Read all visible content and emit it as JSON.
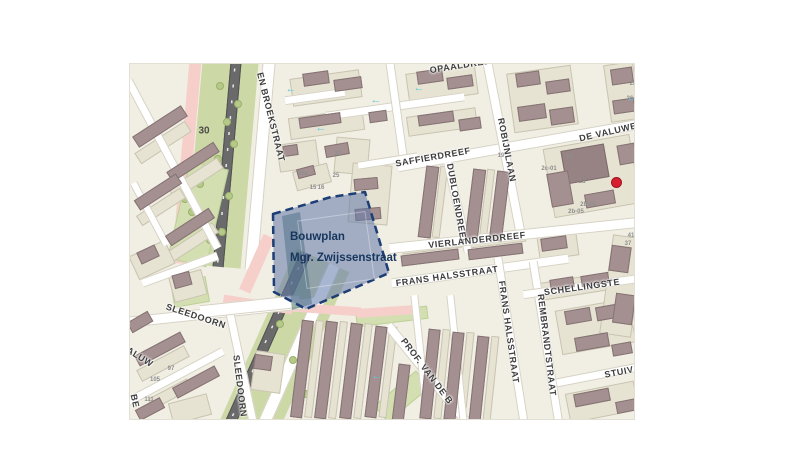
{
  "page": {
    "background": "#ffffff"
  },
  "map": {
    "x": 129,
    "y": 63,
    "w": 506,
    "h": 357,
    "colors": {
      "base": "#f1eee4",
      "street": "#ffffff",
      "parcel": "#e7e3d3",
      "building": "#a49090",
      "building_dark": "#978383",
      "green": "#ccd8a6",
      "tree": "#b5c98a",
      "pink": "#f6cfca",
      "road": "#6a6a6a",
      "label": "#3d3d3d",
      "arrow": "#5fc8de",
      "marker": "#d6202f",
      "plan_fill": "rgba(96,120,170,0.55)",
      "plan_stroke": "#1d3d75",
      "plan_label": "#17365d"
    },
    "bouwplan": {
      "label_line1": "Bouwplan",
      "label_line2": "Mgr. Zwijssenstraat",
      "label_x": 160,
      "label_y": 167,
      "points": "143,150 201,133 235,128 259,209 176,245 144,228",
      "teal_points": "152,152 170,148 182,240 162,246"
    },
    "zone_sign": {
      "text": "30",
      "x": 74,
      "y": 67
    },
    "marker": {
      "x": 486,
      "y": 118,
      "r": 5.5
    },
    "labels": [
      {
        "t": "EN BROEKSTRAAT",
        "x": 141,
        "y": 53,
        "r": 76
      },
      {
        "t": "OPAALDREEF",
        "x": 333,
        "y": 1,
        "r": -9
      },
      {
        "t": "SAFFIERDREEF",
        "x": 303,
        "y": 93,
        "r": -10
      },
      {
        "t": "ROBIJNLAAN",
        "x": 377,
        "y": 86,
        "r": 79
      },
      {
        "t": "DE VALUWE",
        "x": 478,
        "y": 68,
        "r": -13
      },
      {
        "t": "DUBLOENDREEF",
        "x": 327,
        "y": 140,
        "r": 80
      },
      {
        "t": "VIERLANDERDREEF",
        "x": 347,
        "y": 176,
        "r": -6
      },
      {
        "t": "FRANS HALSSTRAAT",
        "x": 317,
        "y": 212,
        "r": -8
      },
      {
        "t": "FRANS HALSSTRAAT",
        "x": 379,
        "y": 268,
        "r": 82
      },
      {
        "t": "REMBRANDTSTRAAT",
        "x": 417,
        "y": 281,
        "r": 83
      },
      {
        "t": "SCHELLINGSTE",
        "x": 452,
        "y": 223,
        "r": -8
      },
      {
        "t": "STUIV",
        "x": 489,
        "y": 308,
        "r": -11
      },
      {
        "t": "SLEEDOORN",
        "x": 66,
        "y": 252,
        "r": 18
      },
      {
        "t": "SLEEDOORN",
        "x": 110,
        "y": 322,
        "r": 83
      },
      {
        "t": "PROF. VAN DE B",
        "x": 297,
        "y": 307,
        "r": 53
      },
      {
        "t": "ALUW",
        "x": 10,
        "y": 293,
        "r": 32
      },
      {
        "t": "BE",
        "x": 5,
        "y": 337,
        "r": 78
      }
    ],
    "house_numbers": [
      {
        "t": "111",
        "x": 19,
        "y": 336
      },
      {
        "t": "105",
        "x": 25,
        "y": 316
      },
      {
        "t": "97",
        "x": 41,
        "y": 305
      },
      {
        "t": "22",
        "x": 208,
        "y": 90
      },
      {
        "t": "26a",
        "x": 173,
        "y": 110
      },
      {
        "t": "15",
        "x": 183,
        "y": 124
      },
      {
        "t": "16",
        "x": 191,
        "y": 124
      },
      {
        "t": "25",
        "x": 206,
        "y": 112
      },
      {
        "t": "19",
        "x": 371,
        "y": 92
      },
      {
        "t": "1b",
        "x": 439,
        "y": 93
      },
      {
        "t": "1a",
        "x": 452,
        "y": 118
      },
      {
        "t": "2c-01",
        "x": 419,
        "y": 105
      },
      {
        "t": "2b-10",
        "x": 458,
        "y": 141
      },
      {
        "t": "2b-05",
        "x": 446,
        "y": 148
      },
      {
        "t": "41",
        "x": 501,
        "y": 172
      },
      {
        "t": "37",
        "x": 498,
        "y": 180
      },
      {
        "t": "28",
        "x": 503,
        "y": 20
      },
      {
        "t": "36",
        "x": 500,
        "y": 35
      }
    ],
    "arrows": [
      [
        161,
        25
      ],
      [
        191,
        64
      ],
      [
        246,
        36
      ],
      [
        289,
        24
      ],
      [
        502,
        34
      ],
      [
        247,
        312
      ]
    ],
    "trees": [
      [
        90,
        22
      ],
      [
        97,
        58
      ],
      [
        88,
        95
      ],
      [
        99,
        132
      ],
      [
        92,
        168
      ],
      [
        70,
        120
      ],
      [
        62,
        148
      ],
      [
        80,
        176
      ],
      [
        55,
        135
      ],
      [
        150,
        260
      ],
      [
        163,
        296
      ],
      [
        176,
        330
      ],
      [
        148,
        238
      ],
      [
        108,
        40
      ],
      [
        104,
        80
      ]
    ],
    "corridor": {
      "segments": [
        {
          "cx": 96,
          "cy": 95,
          "w": 180,
          "h": 215,
          "rot": 5,
          "parts": [
            {
              "name": "cycle-path",
              "kind": "pink",
              "off": -39,
              "w": 12
            },
            {
              "name": "green-corridor",
              "kind": "green",
              "off": -4,
              "w": 56
            },
            {
              "name": "main-road",
              "kind": "road",
              "off": 0,
              "w": 9
            },
            {
              "name": "broekstraat-road",
              "kind": "band",
              "off": 34,
              "w": 13
            }
          ]
        },
        {
          "cx": 136,
          "cy": 275,
          "w": 190,
          "h": 190,
          "rot": 24,
          "parts": [
            {
              "name": "cycle-path",
              "kind": "pink",
              "off": -39,
              "w": 12,
              "hpart": 60
            },
            {
              "name": "green-corridor",
              "kind": "green",
              "off": 20,
              "w": 58
            },
            {
              "name": "main-road",
              "kind": "road",
              "off": 0,
              "w": 9
            },
            {
              "name": "broekstraat-road",
              "kind": "band",
              "off": 32,
              "w": 13
            }
          ]
        }
      ]
    },
    "pink_paths": [
      [
        128,
        240,
        70,
        9,
        9
      ],
      [
        196,
        245,
        70,
        9,
        4
      ],
      [
        256,
        247,
        58,
        9,
        -4
      ]
    ],
    "streets": [
      [
        43,
        100,
        190,
        9,
        62
      ],
      [
        20,
        150,
        70,
        8,
        62
      ],
      [
        50,
        205,
        80,
        9,
        -20
      ],
      [
        90,
        248,
        190,
        11,
        -6
      ],
      [
        111,
        303,
        115,
        9,
        78
      ],
      [
        40,
        315,
        120,
        9,
        -28
      ],
      [
        388,
        81,
        245,
        11,
        -10
      ],
      [
        374,
        84,
        172,
        10,
        79
      ],
      [
        328,
        143,
        92,
        9,
        77
      ],
      [
        384,
        171,
        250,
        11,
        -6
      ],
      [
        350,
        207,
        178,
        10,
        -8
      ],
      [
        381,
        276,
        168,
        9,
        81
      ],
      [
        416,
        278,
        164,
        9,
        81
      ],
      [
        452,
        222,
        118,
        9,
        -8
      ],
      [
        470,
        310,
        88,
        9,
        -11
      ],
      [
        297,
        310,
        125,
        10,
        51
      ],
      [
        291,
        295,
        128,
        8,
        84
      ],
      [
        327,
        295,
        128,
        8,
        84
      ],
      [
        120,
        242,
        100,
        13,
        -6
      ],
      [
        185,
        32,
        60,
        9,
        -8
      ],
      [
        265,
        42,
        140,
        9,
        -8
      ],
      [
        266,
        45,
        95,
        9,
        82
      ],
      [
        258,
        97,
        60,
        8,
        -9
      ]
    ],
    "blocks": [
      [
        "g",
        68,
        150,
        40,
        100,
        13
      ],
      [
        "g",
        60,
        228,
        36,
        26,
        -10
      ],
      [
        "g",
        262,
        252,
        72,
        13,
        -7
      ],
      [
        "g",
        272,
        332,
        22,
        55,
        50
      ],
      [
        "p",
        33,
        78,
        60,
        13,
        -33
      ],
      [
        "p",
        66,
        114,
        58,
        13,
        -33
      ],
      [
        "p",
        31,
        143,
        52,
        12,
        -33
      ],
      [
        "p",
        63,
        178,
        54,
        12,
        -33
      ],
      [
        "p",
        22,
        196,
        40,
        26,
        -25
      ],
      [
        "p",
        58,
        222,
        34,
        26,
        -15
      ],
      [
        "p",
        33,
        299,
        54,
        13,
        -28
      ],
      [
        "p",
        40,
        330,
        44,
        12,
        -28
      ],
      [
        "p",
        60,
        345,
        40,
        22,
        -15
      ],
      [
        "p",
        138,
        308,
        30,
        40,
        8
      ],
      [
        "p",
        184,
        305,
        8,
        98,
        7
      ],
      [
        "p",
        208,
        306,
        8,
        98,
        7
      ],
      [
        "p",
        233,
        307,
        8,
        96,
        7
      ],
      [
        "p",
        258,
        308,
        8,
        92,
        7
      ],
      [
        "p",
        312,
        310,
        8,
        90,
        6
      ],
      [
        "p",
        336,
        312,
        8,
        88,
        6
      ],
      [
        "p",
        361,
        314,
        8,
        85,
        6
      ],
      [
        "p",
        302,
        183,
        60,
        8,
        -7
      ],
      [
        "p",
        367,
        177,
        57,
        8,
        -7
      ],
      [
        "p",
        428,
        182,
        40,
        24,
        -8
      ],
      [
        "p",
        448,
        222,
        80,
        18,
        -9
      ],
      [
        "p",
        465,
        262,
        75,
        45,
        -10
      ],
      [
        "p",
        472,
        338,
        70,
        30,
        -11
      ],
      [
        "p",
        492,
        222,
        32,
        100,
        8
      ],
      [
        "p",
        462,
        112,
        88,
        70,
        -10
      ],
      [
        "p",
        492,
        28,
        30,
        58,
        -8
      ],
      [
        "p",
        412,
        35,
        65,
        60,
        -8
      ],
      [
        "p",
        196,
        24,
        70,
        28,
        -8
      ],
      [
        "p",
        196,
        60,
        75,
        22,
        -8
      ],
      [
        "p",
        168,
        92,
        40,
        28,
        -8
      ],
      [
        "p",
        222,
        92,
        34,
        36,
        5
      ],
      [
        "p",
        182,
        113,
        36,
        20,
        -15
      ],
      [
        "p",
        312,
        20,
        70,
        30,
        -8
      ],
      [
        "p",
        312,
        58,
        70,
        20,
        -8
      ],
      [
        "p",
        357,
        140,
        8,
        70,
        7
      ],
      [
        "p",
        310,
        138,
        8,
        72,
        7
      ],
      [
        "p",
        240,
        130,
        40,
        60,
        5
      ],
      [
        "b",
        30,
        62,
        58,
        13,
        -33
      ],
      [
        "b",
        63,
        98,
        56,
        12,
        -33
      ],
      [
        "b",
        28,
        128,
        50,
        12,
        -33
      ],
      [
        "b",
        60,
        163,
        52,
        12,
        -33
      ],
      [
        "b",
        18,
        190,
        20,
        13,
        -25
      ],
      [
        "b",
        52,
        216,
        18,
        14,
        -15
      ],
      [
        "b",
        30,
        285,
        52,
        12,
        -28
      ],
      [
        "b",
        66,
        318,
        48,
        12,
        -28
      ],
      [
        "b",
        20,
        345,
        28,
        12,
        -28
      ],
      [
        "b",
        10,
        258,
        24,
        12,
        -30
      ],
      [
        "b",
        133,
        298,
        18,
        15,
        8
      ],
      [
        "b",
        172,
        305,
        12,
        98,
        7
      ],
      [
        "b",
        196,
        306,
        12,
        98,
        7
      ],
      [
        "b",
        221,
        307,
        12,
        96,
        7
      ],
      [
        "b",
        246,
        308,
        12,
        92,
        7
      ],
      [
        "b",
        271,
        330,
        12,
        60,
        7
      ],
      [
        "b",
        300,
        310,
        12,
        90,
        6
      ],
      [
        "b",
        324,
        312,
        12,
        88,
        6
      ],
      [
        "b",
        349,
        314,
        12,
        85,
        6
      ],
      [
        "b",
        300,
        193,
        58,
        11,
        -7
      ],
      [
        "b",
        365,
        187,
        55,
        11,
        -7
      ],
      [
        "b",
        424,
        179,
        26,
        13,
        -8
      ],
      [
        "b",
        432,
        219,
        24,
        11,
        -9
      ],
      [
        "b",
        465,
        215,
        28,
        11,
        -9
      ],
      [
        "b",
        448,
        252,
        26,
        14,
        -10
      ],
      [
        "b",
        480,
        248,
        28,
        14,
        -10
      ],
      [
        "b",
        462,
        278,
        34,
        14,
        -10
      ],
      [
        "b",
        492,
        285,
        20,
        12,
        -10
      ],
      [
        "b",
        462,
        333,
        36,
        13,
        -11
      ],
      [
        "b",
        497,
        342,
        22,
        12,
        -11
      ],
      [
        "b",
        490,
        195,
        20,
        26,
        8
      ],
      [
        "b",
        494,
        245,
        20,
        30,
        8
      ],
      [
        "d",
        455,
        100,
        44,
        34,
        -10
      ],
      [
        "b",
        430,
        125,
        22,
        34,
        -10
      ],
      [
        "b",
        470,
        135,
        30,
        14,
        -10
      ],
      [
        "b",
        497,
        90,
        18,
        20,
        -10
      ],
      [
        "b",
        492,
        12,
        22,
        16,
        -8
      ],
      [
        "b",
        494,
        42,
        22,
        14,
        -8
      ],
      [
        "b",
        398,
        15,
        24,
        14,
        -8
      ],
      [
        "b",
        428,
        22,
        24,
        13,
        -8
      ],
      [
        "b",
        402,
        48,
        28,
        15,
        -8
      ],
      [
        "b",
        432,
        52,
        24,
        16,
        -8
      ],
      [
        "b",
        186,
        14,
        26,
        13,
        -8
      ],
      [
        "b",
        218,
        20,
        28,
        12,
        -8
      ],
      [
        "b",
        190,
        56,
        42,
        11,
        -8
      ],
      [
        "b",
        248,
        52,
        18,
        11,
        -8
      ],
      [
        "b",
        160,
        86,
        15,
        11,
        -8
      ],
      [
        "b",
        207,
        86,
        24,
        12,
        -10
      ],
      [
        "b",
        176,
        108,
        18,
        10,
        -15
      ],
      [
        "b",
        300,
        12,
        26,
        13,
        -8
      ],
      [
        "b",
        330,
        18,
        26,
        12,
        -8
      ],
      [
        "b",
        306,
        54,
        36,
        11,
        -8
      ],
      [
        "b",
        340,
        60,
        22,
        12,
        -8
      ],
      [
        "b",
        345,
        140,
        13,
        70,
        7
      ],
      [
        "b",
        369,
        142,
        13,
        70,
        7
      ],
      [
        "b",
        298,
        138,
        13,
        72,
        7
      ],
      [
        "b",
        236,
        120,
        24,
        12,
        -5
      ],
      [
        "b",
        238,
        150,
        26,
        12,
        -5
      ]
    ]
  }
}
